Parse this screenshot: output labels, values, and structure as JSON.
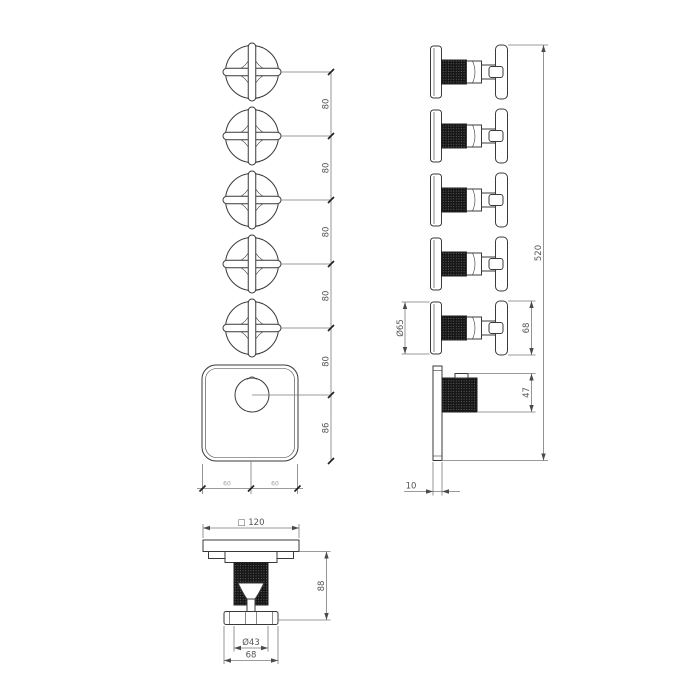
{
  "colors": {
    "line": "#3a3a3a",
    "dimension_line": "#7a7a7a",
    "knurl_fill": "#161616",
    "background": "#ffffff"
  },
  "front_view": {
    "knob_spacing_labels": [
      "80",
      "80",
      "80",
      "80",
      "80",
      "86"
    ],
    "plate_half_labels": [
      "60",
      "60"
    ]
  },
  "side_view": {
    "overall_height_label": "520",
    "flange_diameter_label": "Ø65",
    "handle_height_label": "68",
    "knob_projection_label": "47",
    "plate_thickness_label": "10"
  },
  "bottom_view": {
    "plate_width_label": "□ 120",
    "projection_label": "88",
    "knob_diameter_label": "Ø43",
    "handle_width_label": "68"
  }
}
